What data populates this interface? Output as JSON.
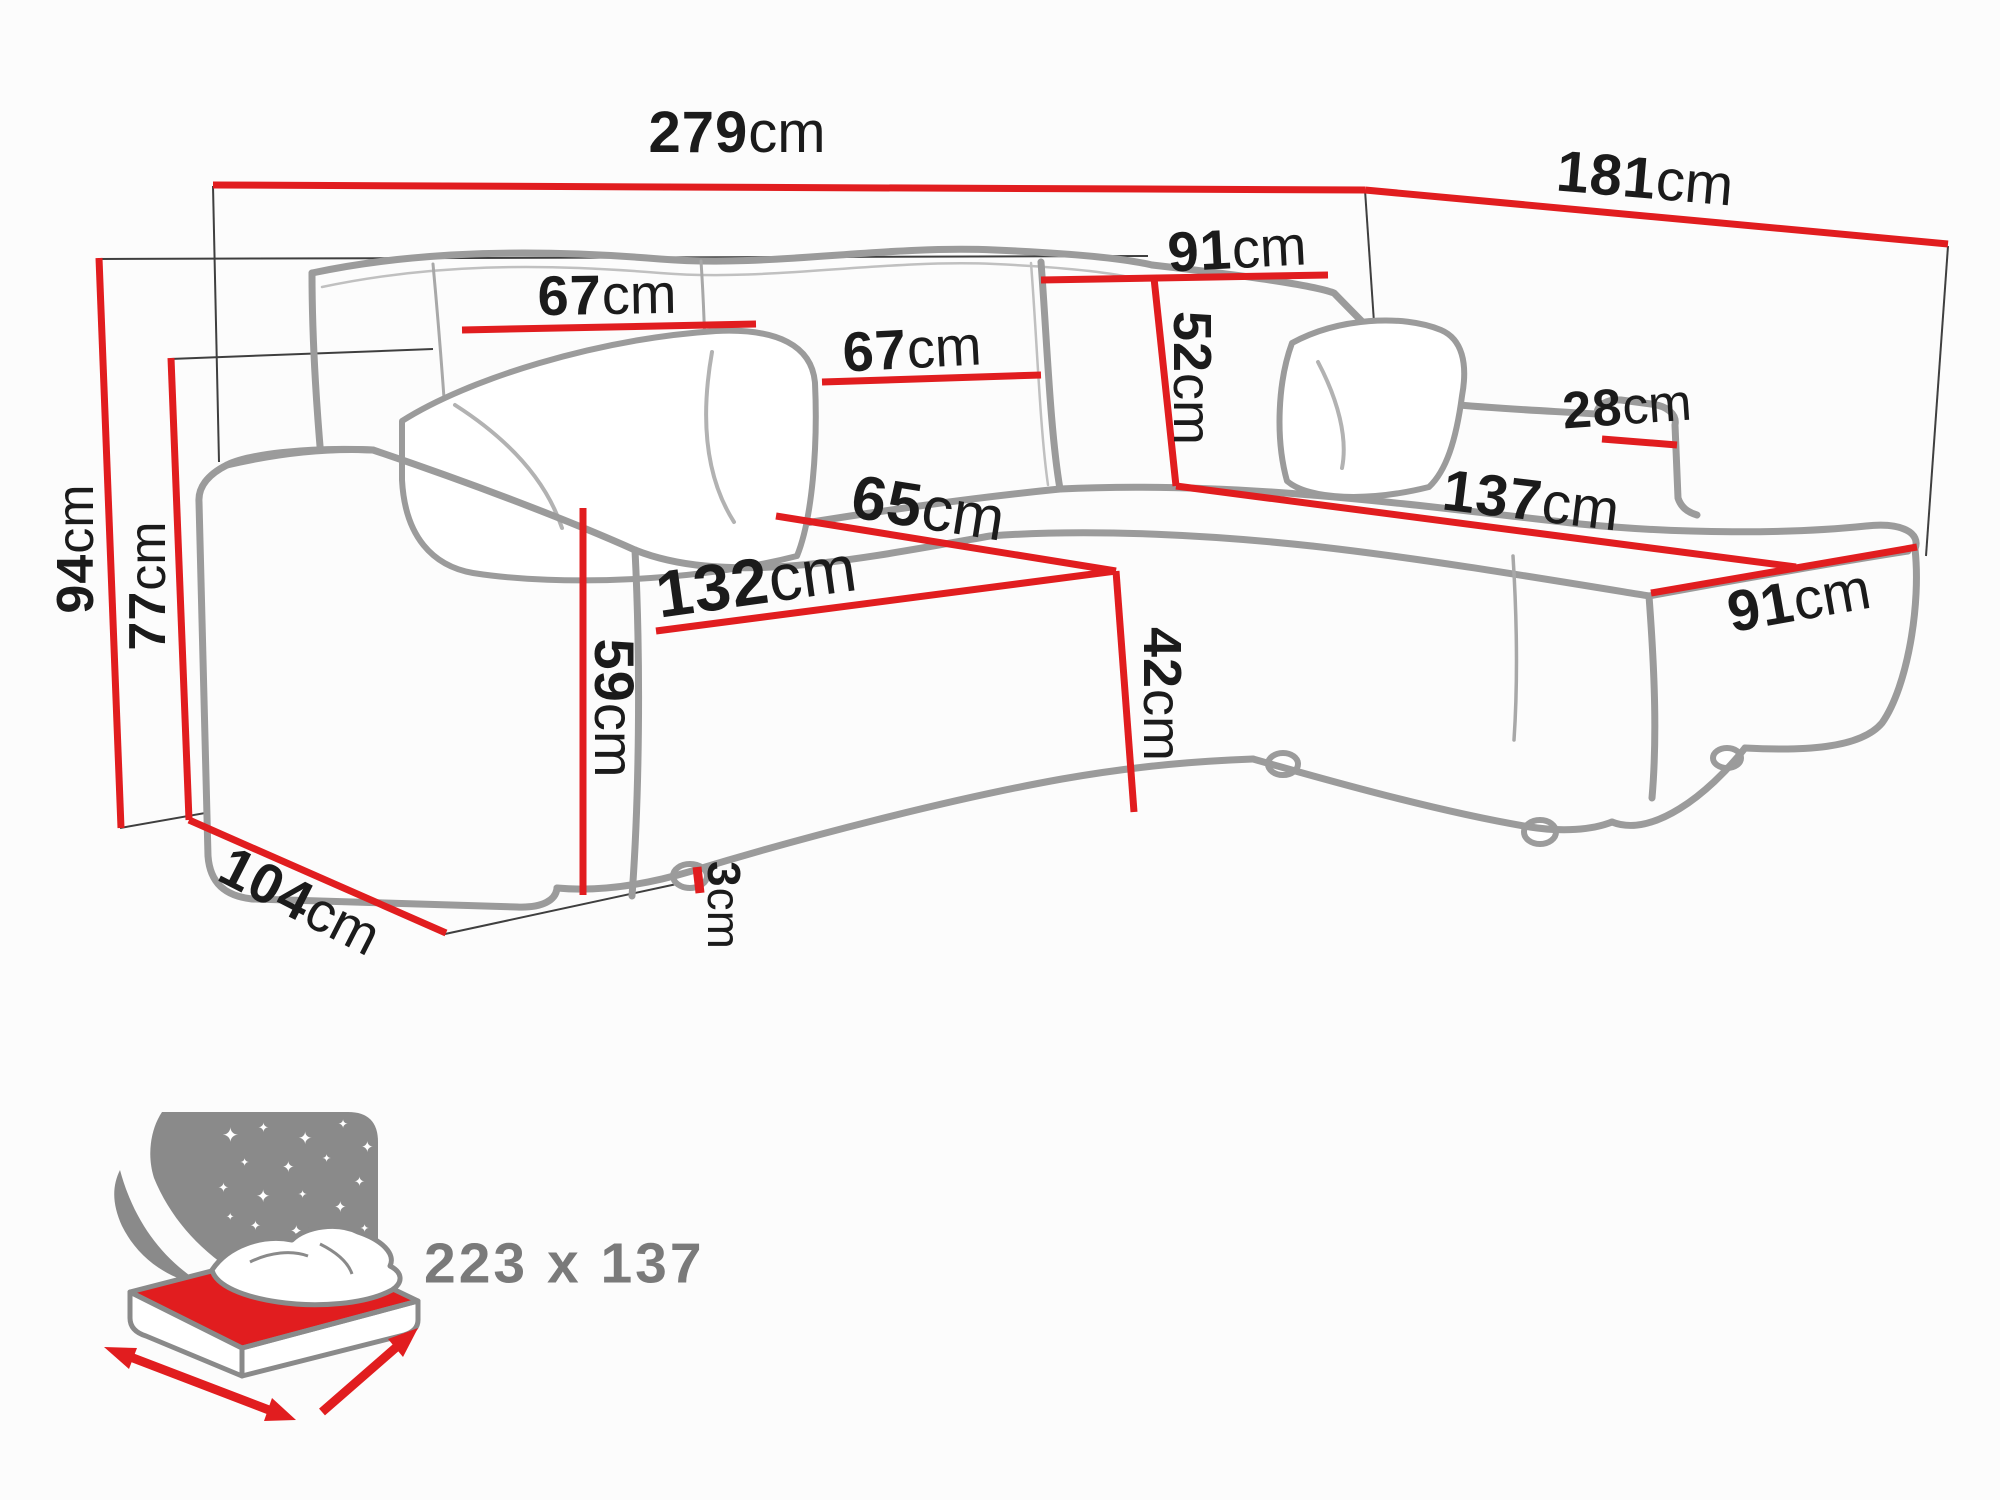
{
  "figure": {
    "type": "corner-sofa-dimension-diagram",
    "units": "cm"
  },
  "colors": {
    "dimension_red": "#e11d1f",
    "sofa_outline_gray": "#9b9b9b",
    "reference_line_black": "#3f3f3f",
    "label_text": "#1b1b1b",
    "bed_caption_gray": "#7a7a7a",
    "bed_sky_gray": "#8a8a8a"
  },
  "dimensions": {
    "total_width": {
      "value": "279",
      "unit": "cm"
    },
    "total_depth": {
      "value": "181",
      "unit": "cm"
    },
    "back_height": {
      "value": "94",
      "unit": "cm"
    },
    "backrest_height": {
      "value": "77",
      "unit": "cm"
    },
    "side_depth": {
      "value": "104",
      "unit": "cm"
    },
    "back_cushion_left": {
      "value": "67",
      "unit": "cm"
    },
    "back_cushion_mid": {
      "value": "67",
      "unit": "cm"
    },
    "corner_section_width": {
      "value": "91",
      "unit": "cm"
    },
    "back_cushion_height": {
      "value": "52",
      "unit": "cm"
    },
    "chaise_armrest": {
      "value": "28",
      "unit": "cm"
    },
    "chaise_length": {
      "value": "137",
      "unit": "cm"
    },
    "chaise_width": {
      "value": "91",
      "unit": "cm"
    },
    "seat_depth": {
      "value": "65",
      "unit": "cm"
    },
    "seat_width": {
      "value": "132",
      "unit": "cm"
    },
    "armrest_height": {
      "value": "59",
      "unit": "cm"
    },
    "seat_height": {
      "value": "42",
      "unit": "cm"
    },
    "leg_height": {
      "value": "3",
      "unit": "cm"
    }
  },
  "bed_icon": {
    "sleeping_area": "223 x 137"
  }
}
